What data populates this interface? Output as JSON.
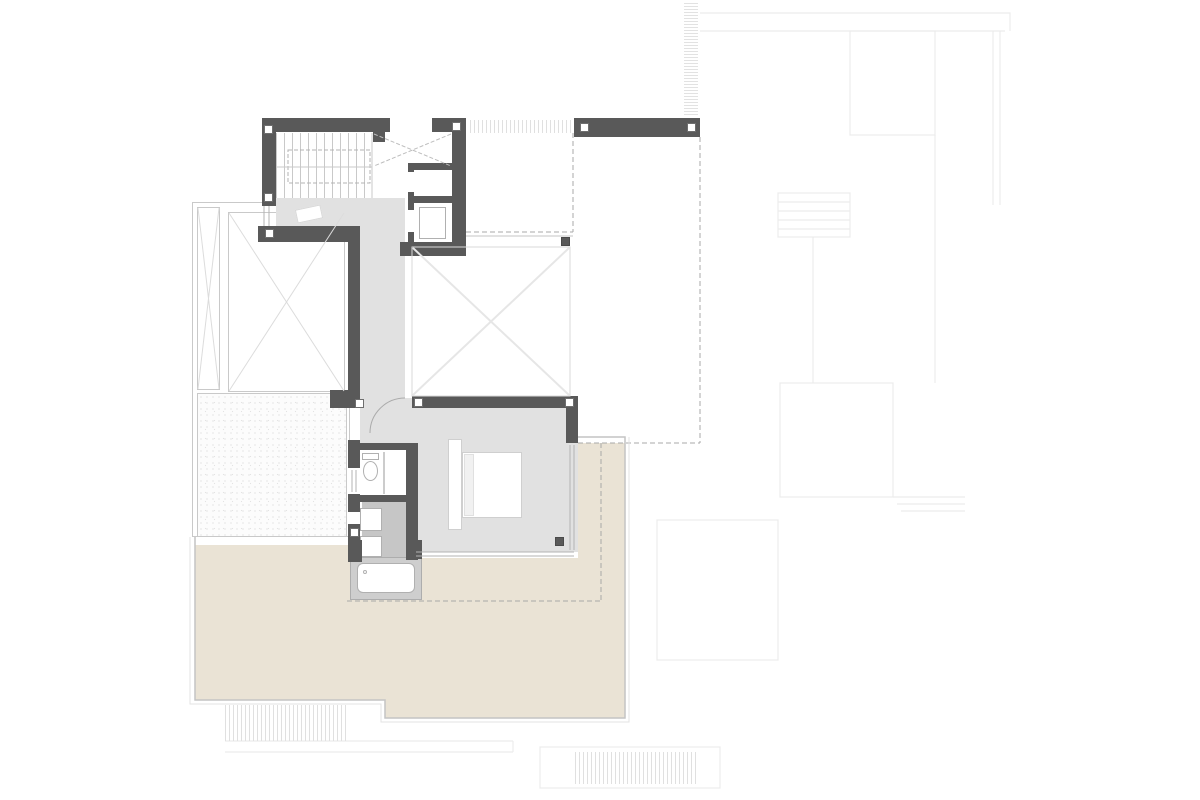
{
  "document": {
    "kind": "architectural-floor-plan",
    "visible_text": [],
    "view": "upper-floor plan with roof terraces, lower roofs shown as faint outlines"
  },
  "colors": {
    "wall": "#595959",
    "floor_gray": "#e1e1e1",
    "shower_gray": "#c6c6c6",
    "tub_surround": "#cecece",
    "terrace_beige": "#eae3d5",
    "thin_line": "#c4c4c4",
    "glazing_line": "#b3b3b3",
    "faint_line": "#ececec",
    "dash_line": "#a8a8a8",
    "x_line": "#e6e6e6",
    "skylight_line": "#dcdcdc",
    "stair_line": "#c9c9c9",
    "white": "#ffffff"
  },
  "regions": [
    {
      "name": "stair-hall",
      "fill": "floor_gray"
    },
    {
      "name": "staircase",
      "fill": "white"
    },
    {
      "name": "stair-void-cross",
      "fill": "white"
    },
    {
      "name": "elevator-shaft",
      "fill": "white"
    },
    {
      "name": "corridor",
      "fill": "floor_gray"
    },
    {
      "name": "double-height-void",
      "fill": "white"
    },
    {
      "name": "bedroom",
      "fill": "floor_gray"
    },
    {
      "name": "bathroom",
      "fill": "white"
    },
    {
      "name": "shower-area",
      "fill": "shower_gray"
    },
    {
      "name": "bathtub",
      "fill": "tub_surround"
    },
    {
      "name": "terrace",
      "fill": "terrace_beige"
    },
    {
      "name": "gravel-roof",
      "fill": "white"
    },
    {
      "name": "skylights",
      "fill": "white"
    },
    {
      "name": "lower-roof-outlines",
      "fill": "white"
    }
  ],
  "columns_note": "small square column markers at wall junctions"
}
